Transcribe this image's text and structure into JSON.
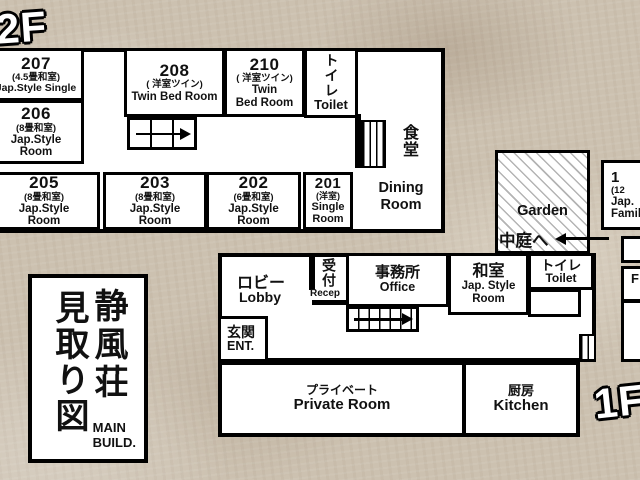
{
  "building": {
    "title_jp_1": "静風荘",
    "title_jp_2": "見取り図",
    "title_en_1": "MAIN",
    "title_en_2": "BUILD."
  },
  "floor2": {
    "label": "2F",
    "rooms": [
      {
        "number": "207",
        "type_jp": "(4.5畳和室)",
        "en1": "Jap.Style Single",
        "en2": ""
      },
      {
        "number": "206",
        "type_jp": "(8畳和室)",
        "en1": "Jap.Style",
        "en2": "Room"
      },
      {
        "number": "208",
        "type_jp": "( 洋室ツイン)",
        "en1": "Twin Bed Room",
        "en2": ""
      },
      {
        "number": "210",
        "type_jp": "( 洋室ツイン)",
        "en1": "Twin",
        "en2": "Bed Room"
      },
      {
        "number": "205",
        "type_jp": "(8畳和室)",
        "en1": "Jap.Style",
        "en2": "Room"
      },
      {
        "number": "203",
        "type_jp": "(8畳和室)",
        "en1": "Jap.Style",
        "en2": "Room"
      },
      {
        "number": "202",
        "type_jp": "(6畳和室)",
        "en1": "Jap.Style",
        "en2": "Room"
      },
      {
        "number": "201",
        "type_jp": "(洋室)",
        "en1": "Single",
        "en2": "Room"
      }
    ],
    "toilet_jp": "トイレ",
    "toilet_en": "Toilet",
    "dining_jp": "食堂",
    "dining_en1": "Dining",
    "dining_en2": "Room"
  },
  "floor1": {
    "label": "1F",
    "lobby_jp": "ロビー",
    "lobby_en": "Lobby",
    "reception_jp": "受付",
    "reception_en": "Recep",
    "office_jp": "事務所",
    "office_en": "Office",
    "washitsu_jp": "和室",
    "washitsu_en1": "Jap. Style",
    "washitsu_en2": "Room",
    "toilet_jp": "トイレ",
    "toilet_en": "Toilet",
    "entrance_jp": "玄関",
    "entrance_en": "ENT.",
    "private_jp": "プライベート",
    "private_en": "Private Room",
    "kitchen_jp": "厨房",
    "kitchen_en": "Kitchen"
  },
  "garden": {
    "en": "Garden",
    "jp": "中庭へ"
  },
  "partial_right": {
    "line1": "1",
    "line2": "(12",
    "line3": "Jap.",
    "line4": "Family",
    "mid": "F"
  },
  "colors": {
    "wall": "#000000",
    "room_bg": "#ffffff",
    "background": "#ccc1b0"
  }
}
